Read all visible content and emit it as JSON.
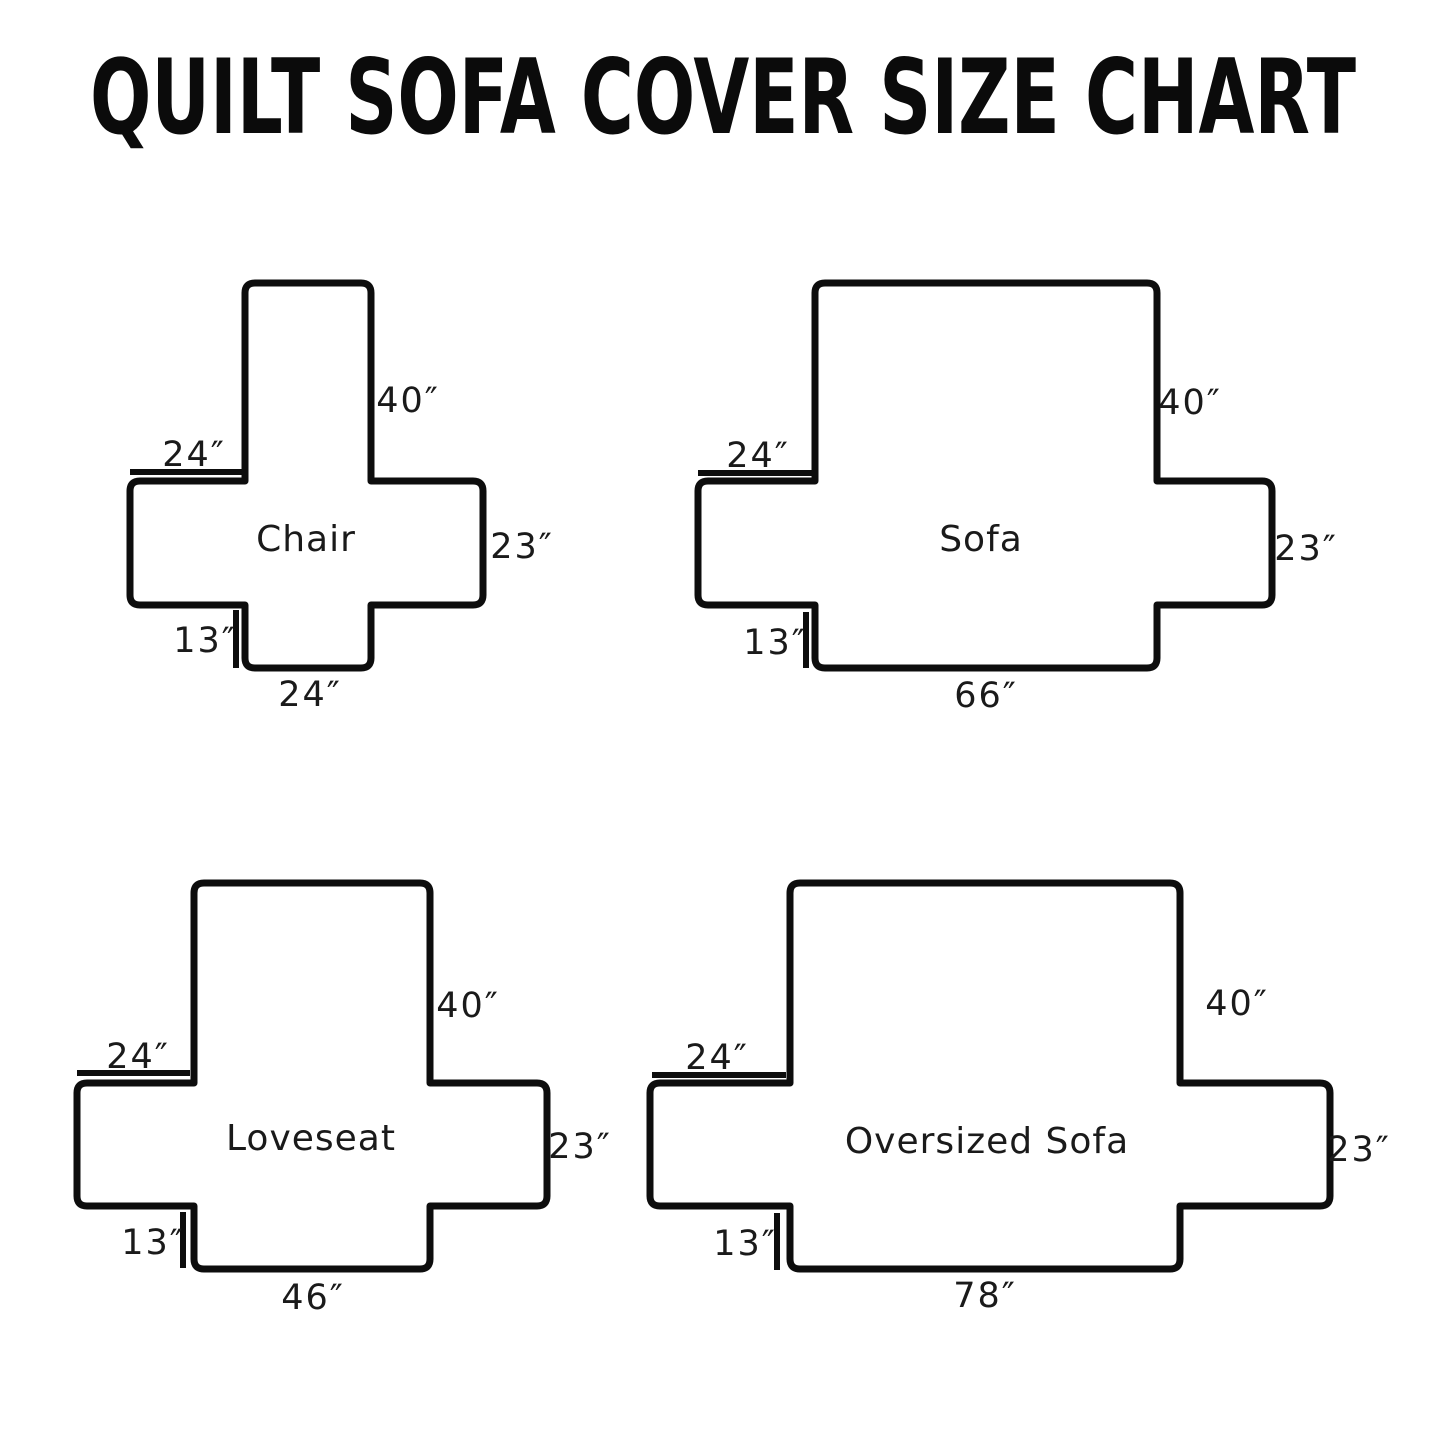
{
  "title": "QUILT SOFA COVER SIZE CHART",
  "diagrams": [
    {
      "name": "Chair",
      "back_height": "40″",
      "arm_width": "24″",
      "seat_side": "23″",
      "front_drop": "13″",
      "front_width": "24″"
    },
    {
      "name": "Sofa",
      "back_height": "40″",
      "arm_width": "24″",
      "seat_side": "23″",
      "front_drop": "13″",
      "front_width": "66″"
    },
    {
      "name": "Loveseat",
      "back_height": "40″",
      "arm_width": "24″",
      "seat_side": "23″",
      "front_drop": "13″",
      "front_width": "46″"
    },
    {
      "name": "Oversized Sofa",
      "back_height": "40″",
      "arm_width": "24″",
      "seat_side": "23″",
      "front_drop": "13″",
      "front_width": "78″"
    }
  ]
}
